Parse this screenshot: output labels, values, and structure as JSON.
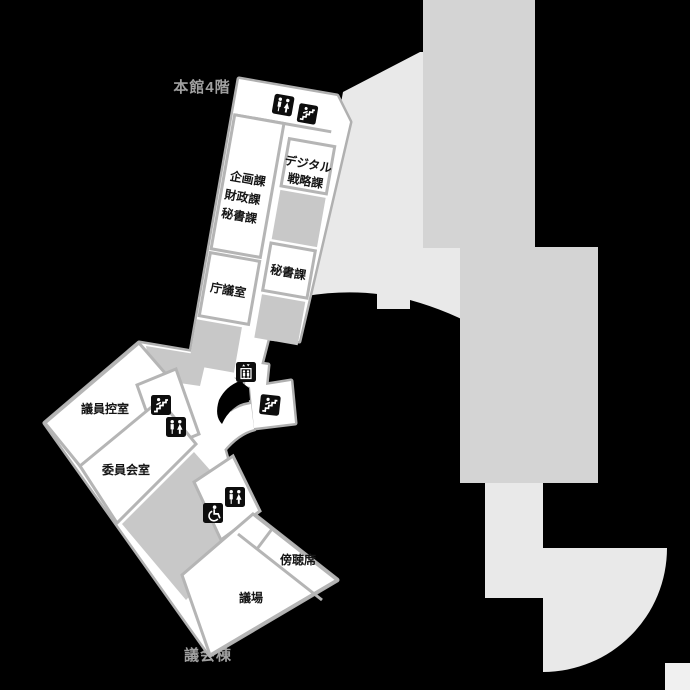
{
  "map_title": "庁舎フロアマップ（議会フロア）",
  "palette": {
    "background": "#000000",
    "floor_fill": "#ffffff",
    "wall_stroke": "#b0b0b0",
    "divider_stroke": "#b5b5b5",
    "gray_room": "#c8c8c8",
    "silhouette_mid": "#d4d4d4",
    "silhouette_light": "#e9e9e9",
    "silhouette_corner": "#f0f0f0",
    "icon_bg": "#0d0d0d",
    "icon_fg": "#ffffff",
    "dim_label_color": "#a0a0a0",
    "room_text_color": "#151515"
  },
  "rooms": {
    "kikaku_line1": "企画課",
    "kikaku_line2": "財政課",
    "kikaku_line3": "秘書課",
    "chougi": "庁議室",
    "digital_line1": "デジタル",
    "digital_line2": "戦略課",
    "hisho": "秘書課",
    "giin": "議員控室",
    "iinkai": "委員会室",
    "bouchou": "傍聴席",
    "gijou": "議場"
  },
  "edge_labels": {
    "top": "本館4階",
    "bottom": "議会棟"
  },
  "icons": [
    {
      "name": "restroom-icon",
      "location": "upper-wing-corridor"
    },
    {
      "name": "stairs-icon",
      "location": "upper-wing-top-right"
    },
    {
      "name": "elevator-icon",
      "location": "central-corridor"
    },
    {
      "name": "stairs-icon",
      "location": "central-stair-room"
    },
    {
      "name": "stairs-icon",
      "location": "lower-wing-room"
    },
    {
      "name": "restroom-icon",
      "location": "lower-wing-room"
    },
    {
      "name": "restroom-icon",
      "location": "assembly-hall-entry"
    },
    {
      "name": "wheelchair-icon",
      "location": "assembly-hall-entry"
    }
  ]
}
